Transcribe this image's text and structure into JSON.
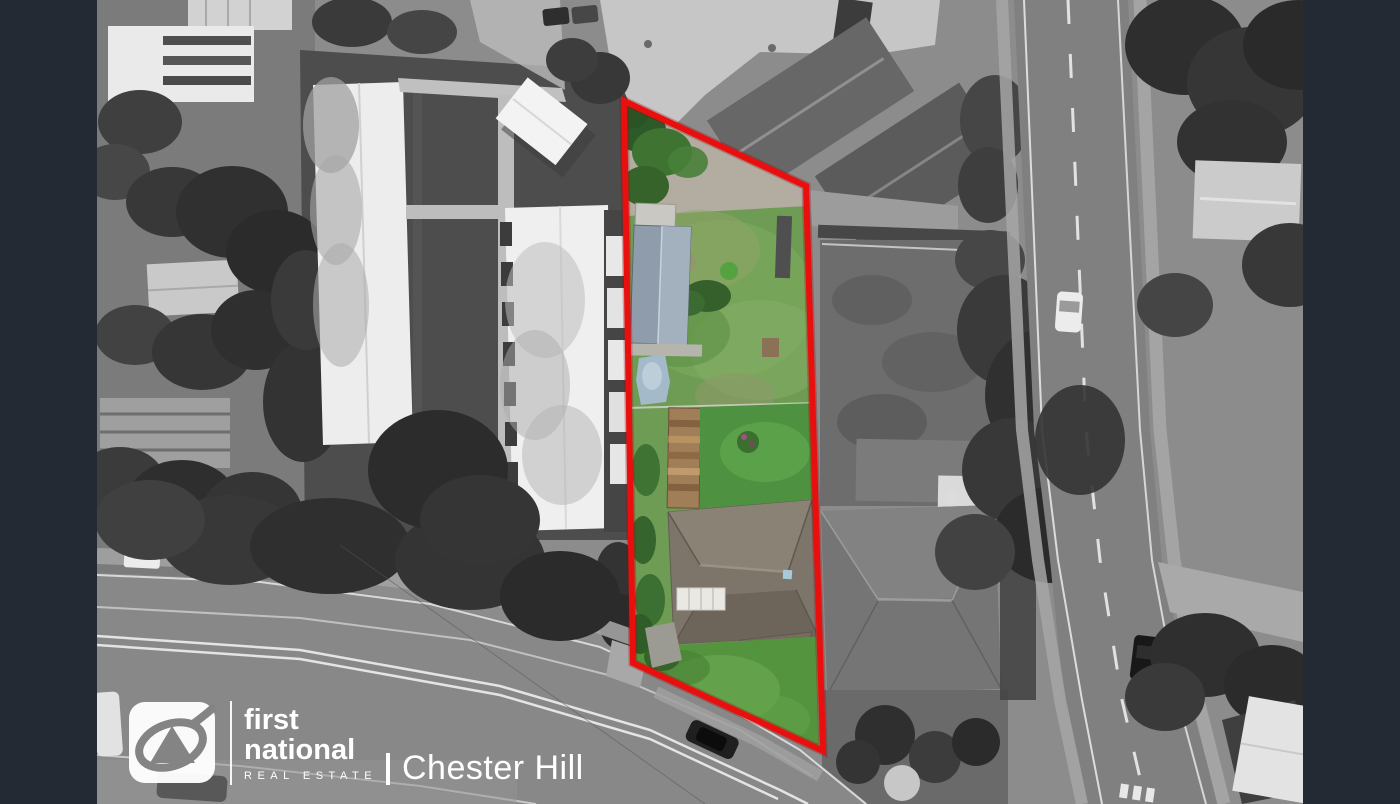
{
  "canvas": {
    "width_px": 1400,
    "height_px": 804
  },
  "watermark": {
    "brand_word_1": "first",
    "brand_word_2": "national",
    "brand_tagline": "REAL ESTATE",
    "office_name": "Chester Hill"
  },
  "scene": {
    "type": "aerial-photograph-with-property-boundary",
    "palette": {
      "letterbox_bar": "#232a33",
      "boundary_outline_red": "#ea0f0f",
      "surroundings_grayscale_base": "#8c8c8c",
      "lot_grass_green": "#6e9c54",
      "lot_back_lawn_green": "#4e9140",
      "shed_roof_blue_grey": "#98a6b4",
      "lot_house_roof_grey_brown": "#7d756a",
      "watermark_white": "#ffffff"
    }
  }
}
